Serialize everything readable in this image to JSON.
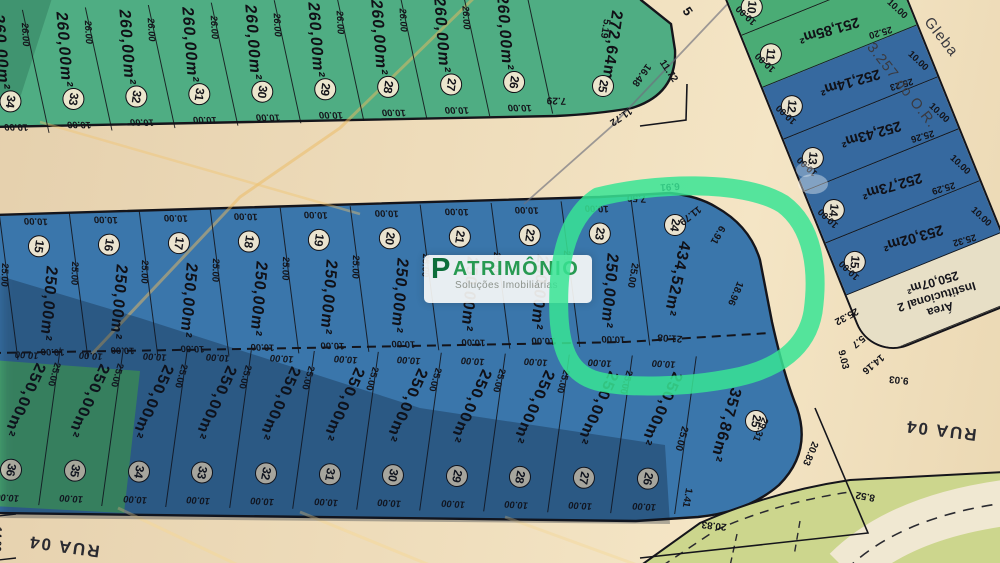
{
  "brand": {
    "p": "P",
    "rest": "ATRIMÔNIO",
    "tagline": "Soluções Imobiliárias"
  },
  "corner_text": {
    "line1": "Gleba",
    "line2": "3.257 do O.R."
  },
  "streets": {
    "bottom_left": "RUA 04",
    "right": "RUA 04",
    "diagonal_number": "5"
  },
  "edge_dims": {
    "street_left_width": "14.00",
    "corner_diag_a": "11.72",
    "corner_diag_b": "11.72",
    "south_diag_a": "20.83",
    "south_diag_b": "20.83",
    "far_block_dim": "8.52"
  },
  "top_block": {
    "area_label": "260,00m²",
    "depth": "26.00",
    "frontage": "10.00",
    "lot_numbers": [
      "34",
      "33",
      "32",
      "31",
      "30",
      "29",
      "28",
      "27",
      "26"
    ],
    "corner_lot": {
      "number": "25",
      "area": "272,64m²",
      "dim_top": "5.19",
      "dim_right": "16.48",
      "dim_bottom": "7.29"
    }
  },
  "middle_block": {
    "area_label": "250,00m²",
    "depth": "25.00",
    "frontage": "10.00",
    "lot_numbers": [
      "15",
      "16",
      "17",
      "18",
      "19",
      "20",
      "21",
      "22",
      "23"
    ],
    "corner_lot": {
      "number": "24",
      "area": "434,52m²",
      "dim_top": "7.50",
      "dim_top_right": "6.91",
      "dim_arc": "11.79",
      "dim_right_upper": "6.91",
      "dim_right": "18.96",
      "dim_bottom": "21.08",
      "dim_left": "25.00"
    }
  },
  "bottom_block": {
    "area_label": "250,00m²",
    "depth": "25.00",
    "frontage": "10.00",
    "lot_numbers": [
      "36",
      "35",
      "34",
      "33",
      "32",
      "31",
      "30",
      "29",
      "28",
      "27",
      "26"
    ],
    "corner_lot": {
      "number": "25",
      "area": "357,86m²",
      "dim_left": "25.00",
      "dim_right": "29.31",
      "dim_corner": "1.41"
    }
  },
  "right_block": {
    "frontage": "10.00",
    "lots": [
      {
        "number": "10",
        "area": "251,55m²",
        "depth": "25.17"
      },
      {
        "number": "11",
        "area": "251,85m²",
        "depth": "25.20"
      },
      {
        "number": "12",
        "area": "252,14m²",
        "depth": "25.23"
      },
      {
        "number": "13",
        "area": "252,43m²",
        "depth": "25.26"
      },
      {
        "number": "14",
        "area": "252,73m²",
        "depth": "25.29"
      },
      {
        "number": "15",
        "area": "253,02m²",
        "depth": "25.32"
      }
    ],
    "institutional": {
      "line1": "Área",
      "line2": "Institucional 2",
      "area": "250,07m²",
      "dim_top": "25.32",
      "dim_a": "5.7",
      "dim_b": "14.16",
      "dim_c": "9.03",
      "dim_d": "9.03"
    }
  },
  "colors": {
    "highlight": "#38e494",
    "green_lot": "#4fad83",
    "green_lot_b": "#4aac75",
    "blue_lot": "#3a76ab",
    "blue_lot_b": "#36699f",
    "institutional_fill": "#e7dfc6",
    "paper": "#ecdcba",
    "watermark_green": "#279a52",
    "watermark_dark_green": "#0d6d3a"
  }
}
